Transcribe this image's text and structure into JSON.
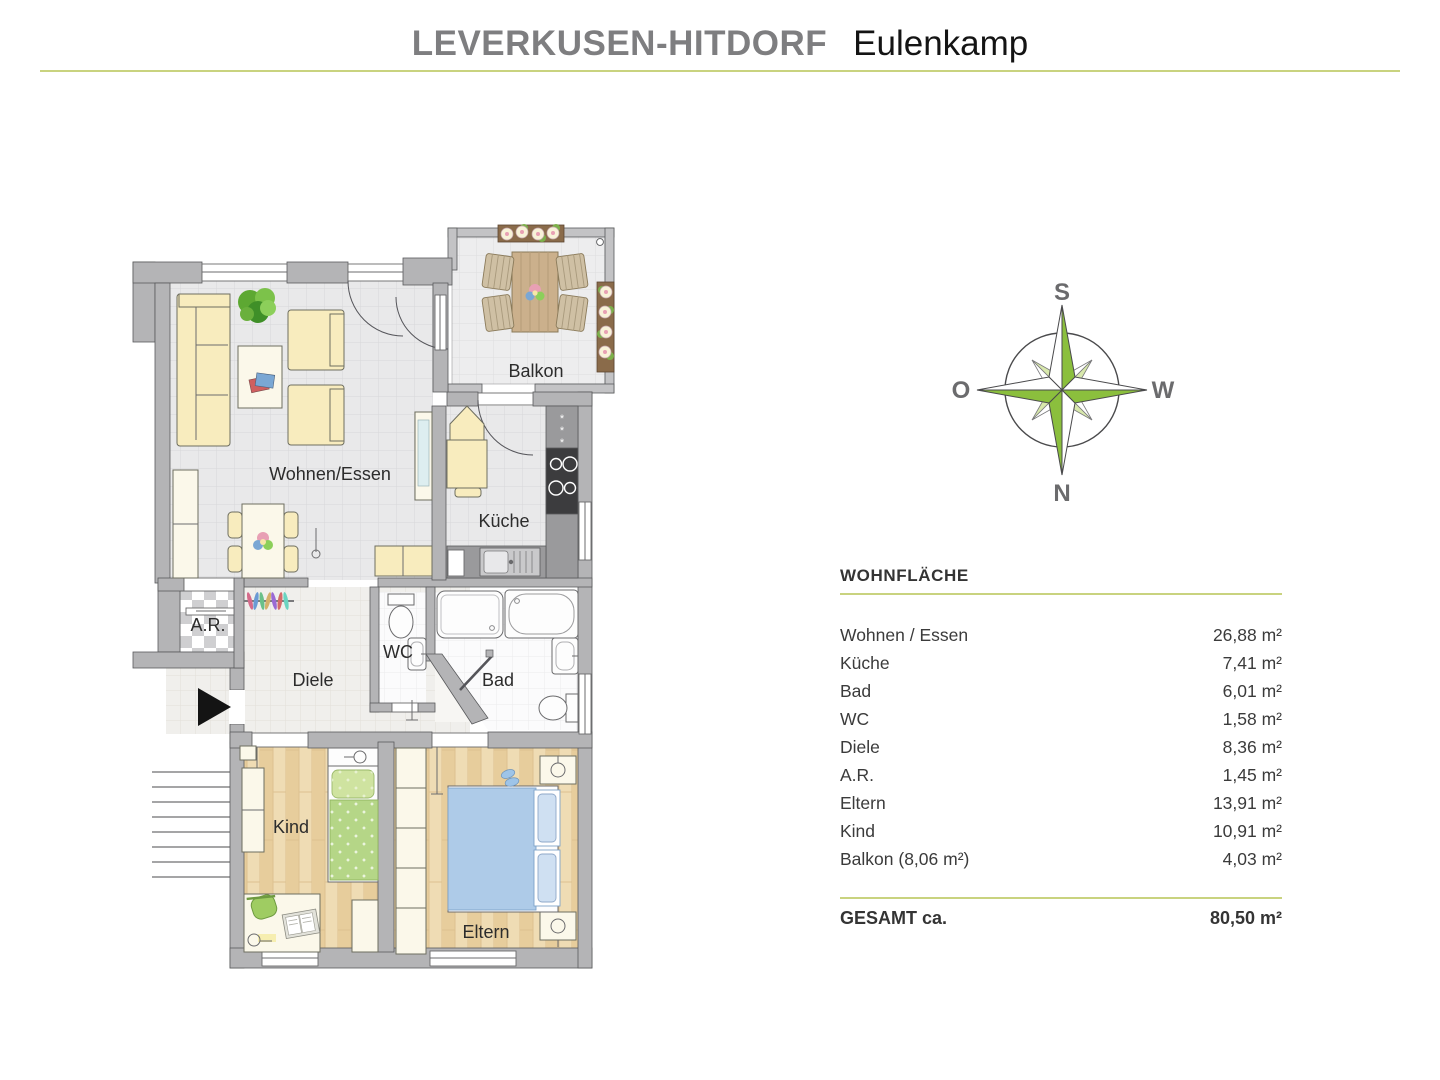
{
  "header": {
    "location": "LEVERKUSEN-HITDORF",
    "project": "Eulenkamp"
  },
  "floorplan": {
    "rooms": {
      "living": "Wohnen/Essen",
      "kitchen": "Küche",
      "balcony": "Balkon",
      "wc": "WC",
      "bath": "Bad",
      "hall": "Diele",
      "storage": "A.R.",
      "child": "Kind",
      "parents": "Eltern"
    }
  },
  "compass": {
    "north": "N",
    "south": "S",
    "east": "O",
    "west": "W"
  },
  "area_table": {
    "title": "WOHNFLÄCHE",
    "rows": [
      {
        "label": "Wohnen / Essen",
        "value": "26,88 m²"
      },
      {
        "label": "Küche",
        "value": "7,41 m²"
      },
      {
        "label": "Bad",
        "value": "6,01 m²"
      },
      {
        "label": "WC",
        "value": "1,58 m²"
      },
      {
        "label": "Diele",
        "value": "8,36 m²"
      },
      {
        "label": "A.R.",
        "value": "1,45 m²"
      },
      {
        "label": "Eltern",
        "value": "13,91 m²"
      },
      {
        "label": "Kind",
        "value": "10,91 m²"
      },
      {
        "label": "Balkon (8,06 m²)",
        "value": "4,03 m²"
      }
    ],
    "total_label": "GESAMT ca.",
    "total_value": "80,50 m²"
  },
  "colors": {
    "accent_rule": "#c9d37f",
    "wall_gray": "#b4b4b6",
    "compass_green": "#8bbf3d",
    "compass_light_green": "#d8e8ac",
    "wood_floor": "#ebd5a9",
    "furniture_cream": "#f8ecbe",
    "child_bed_green": "#b5d687",
    "parent_bed_blue": "#aecbe8"
  }
}
